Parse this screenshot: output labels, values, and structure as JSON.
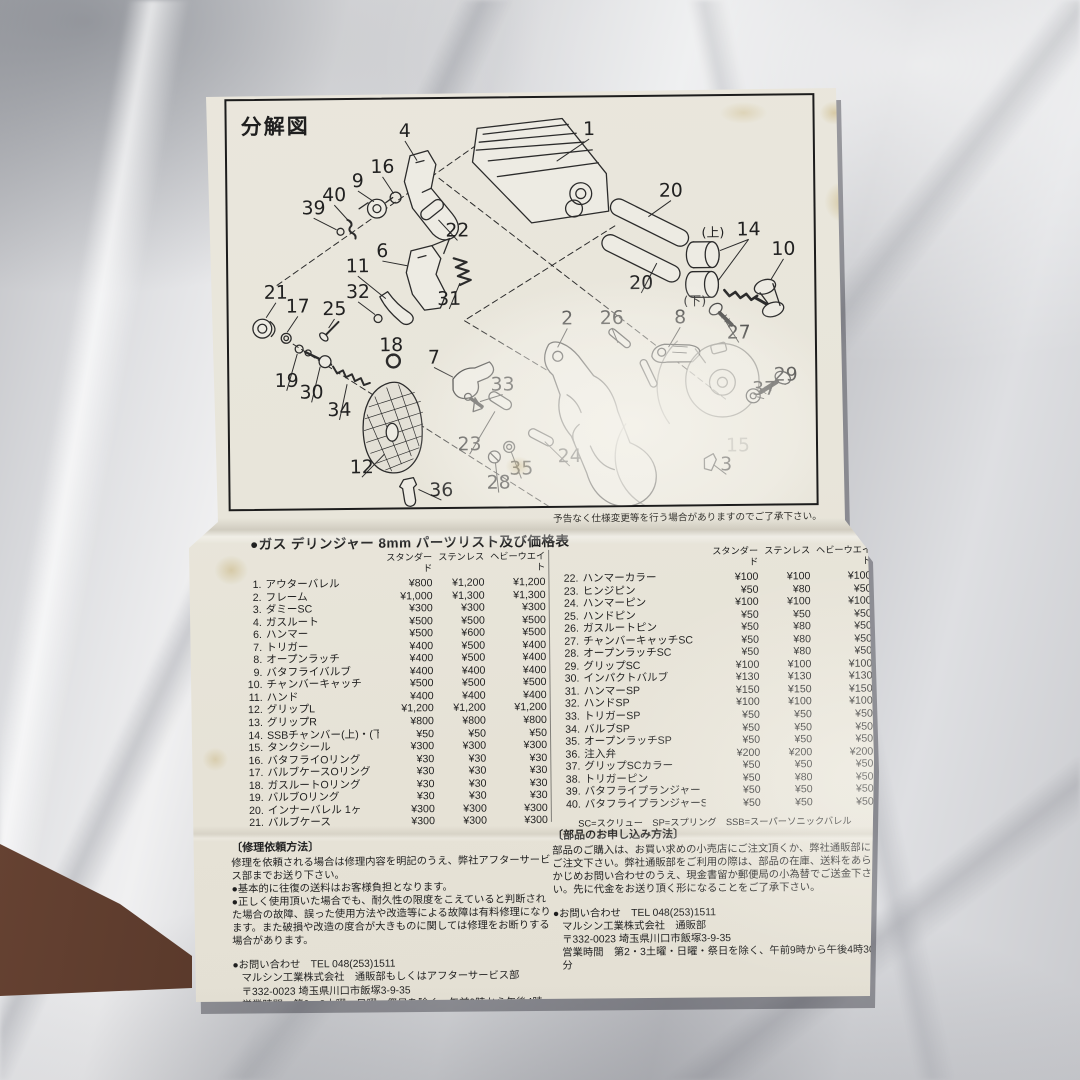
{
  "diagram": {
    "title": "分解図",
    "note": "予告なく仕様変更等を行う場合がありますのでご了承下さい。",
    "labels": [
      {
        "t": "1",
        "x": 365,
        "y": 38,
        "lx": 332,
        "ly": 64
      },
      {
        "t": "4",
        "x": 179,
        "y": 38,
        "lx": 191,
        "ly": 62
      },
      {
        "t": "16",
        "x": 156,
        "y": 74,
        "lx": 167,
        "ly": 95
      },
      {
        "t": "9",
        "x": 131,
        "y": 88,
        "lx": 147,
        "ly": 103
      },
      {
        "t": "40",
        "x": 107,
        "y": 102,
        "lx": 123,
        "ly": 124
      },
      {
        "t": "39",
        "x": 86,
        "y": 115,
        "lx": 109,
        "ly": 131
      },
      {
        "t": "22",
        "x": 231,
        "y": 139,
        "lx": 212,
        "ly": 122
      },
      {
        "t": "20",
        "x": 447,
        "y": 101,
        "lx": 424,
        "ly": 121
      },
      {
        "t": "(上)",
        "x": 489,
        "y": 142,
        "small": 1
      },
      {
        "t": "14",
        "x": 525,
        "y": 141,
        "lx": 496,
        "ly": 156,
        "lx2": 494,
        "ly2": 186
      },
      {
        "t": "10",
        "x": 560,
        "y": 161,
        "lx": 547,
        "ly": 186
      },
      {
        "t": "6",
        "x": 155,
        "y": 159,
        "lx": 180,
        "ly": 168
      },
      {
        "t": "11",
        "x": 130,
        "y": 174,
        "lx": 158,
        "ly": 201
      },
      {
        "t": "31",
        "x": 222,
        "y": 208,
        "lx": 233,
        "ly": 186
      },
      {
        "t": "20",
        "x": 416,
        "y": 194,
        "lx": 432,
        "ly": 168
      },
      {
        "t": "(下)",
        "x": 470,
        "y": 211,
        "small": 1
      },
      {
        "t": "27",
        "x": 514,
        "y": 245,
        "lx": 500,
        "ly": 226
      },
      {
        "t": "2",
        "x": 341,
        "y": 229,
        "lx": 331,
        "ly": 252
      },
      {
        "t": "26",
        "x": 386,
        "y": 229,
        "lx": 392,
        "ly": 248
      },
      {
        "t": "8",
        "x": 455,
        "y": 229,
        "lx": 443,
        "ly": 253
      },
      {
        "t": "21",
        "x": 47,
        "y": 200,
        "lx": 37,
        "ly": 219
      },
      {
        "t": "17",
        "x": 69,
        "y": 214,
        "lx": 58,
        "ly": 234
      },
      {
        "t": "25",
        "x": 106,
        "y": 217,
        "lx": 100,
        "ly": 230
      },
      {
        "t": "32",
        "x": 130,
        "y": 200,
        "lx": 147,
        "ly": 217
      },
      {
        "t": "18",
        "x": 163,
        "y": 254,
        "lx": 165,
        "ly": 259
      },
      {
        "t": "7",
        "x": 206,
        "y": 267,
        "lx": 225,
        "ly": 281
      },
      {
        "t": "33",
        "x": 275,
        "y": 295,
        "lx": 252,
        "ly": 306
      },
      {
        "t": "19",
        "x": 57,
        "y": 289,
        "lx": 68,
        "ly": 256
      },
      {
        "t": "30",
        "x": 82,
        "y": 301,
        "lx": 91,
        "ly": 269
      },
      {
        "t": "34",
        "x": 110,
        "y": 319,
        "lx": 118,
        "ly": 287
      },
      {
        "t": "29",
        "x": 561,
        "y": 288,
        "lx": 551,
        "ly": 289
      },
      {
        "t": "37",
        "x": 539,
        "y": 302,
        "lx": 532,
        "ly": 304
      },
      {
        "t": "23",
        "x": 241,
        "y": 355,
        "lx": 267,
        "ly": 316
      },
      {
        "t": "12",
        "x": 132,
        "y": 377,
        "lx": 155,
        "ly": 358
      },
      {
        "t": "35",
        "x": 293,
        "y": 380,
        "lx": 283,
        "ly": 357
      },
      {
        "t": "28",
        "x": 270,
        "y": 394,
        "lx": 267,
        "ly": 368
      },
      {
        "t": "24",
        "x": 342,
        "y": 368,
        "lx": 317,
        "ly": 347
      },
      {
        "t": "36",
        "x": 212,
        "y": 401,
        "lx": 189,
        "ly": 394
      },
      {
        "t": "3",
        "x": 500,
        "y": 378,
        "lx": 487,
        "ly": 372
      },
      {
        "t": "15",
        "x": 512,
        "y": 359,
        "faint": 1
      }
    ]
  },
  "price_table": {
    "title": "●ガス デリンジャー 8mm パーツリスト及び価格表",
    "columns": [
      "スタンダード",
      "ステンレス",
      "ヘビーウエイト"
    ],
    "left_rows": [
      [
        "1.",
        "アウターバレル",
        "¥800",
        "¥1,200",
        "¥1,200"
      ],
      [
        "2.",
        "フレーム",
        "¥1,000",
        "¥1,300",
        "¥1,300"
      ],
      [
        "3.",
        "ダミーSC",
        "¥300",
        "¥300",
        "¥300"
      ],
      [
        "4.",
        "ガスルート",
        "¥500",
        "¥500",
        "¥500"
      ],
      [
        "6.",
        "ハンマー",
        "¥500",
        "¥600",
        "¥500"
      ],
      [
        "7.",
        "トリガー",
        "¥400",
        "¥500",
        "¥400"
      ],
      [
        "8.",
        "オープンラッチ",
        "¥400",
        "¥500",
        "¥400"
      ],
      [
        "9.",
        "バタフライバルブ",
        "¥400",
        "¥400",
        "¥400"
      ],
      [
        "10.",
        "チャンバーキャッチ",
        "¥500",
        "¥500",
        "¥500"
      ],
      [
        "11.",
        "ハンド",
        "¥400",
        "¥400",
        "¥400"
      ],
      [
        "12.",
        "グリップL",
        "¥1,200",
        "¥1,200",
        "¥1,200"
      ],
      [
        "13.",
        "グリップR",
        "¥800",
        "¥800",
        "¥800"
      ],
      [
        "14.",
        "SSBチャンバー(上)・(下)各",
        "¥50",
        "¥50",
        "¥50"
      ],
      [
        "15.",
        "タンクシール",
        "¥300",
        "¥300",
        "¥300"
      ],
      [
        "16.",
        "バタフライOリング",
        "¥30",
        "¥30",
        "¥30"
      ],
      [
        "17.",
        "バルブケースOリング",
        "¥30",
        "¥30",
        "¥30"
      ],
      [
        "18.",
        "ガスルートOリング",
        "¥30",
        "¥30",
        "¥30"
      ],
      [
        "19.",
        "バルブOリング",
        "¥30",
        "¥30",
        "¥30"
      ],
      [
        "20.",
        "インナーバレル 1ヶ",
        "¥300",
        "¥300",
        "¥300"
      ],
      [
        "21.",
        "バルブケース",
        "¥300",
        "¥300",
        "¥300"
      ]
    ],
    "right_rows": [
      [
        "22.",
        "ハンマーカラー",
        "¥100",
        "¥100",
        "¥100"
      ],
      [
        "23.",
        "ヒンジピン",
        "¥50",
        "¥80",
        "¥50"
      ],
      [
        "24.",
        "ハンマーピン",
        "¥100",
        "¥100",
        "¥100"
      ],
      [
        "25.",
        "ハンドピン",
        "¥50",
        "¥50",
        "¥50"
      ],
      [
        "26.",
        "ガスルートピン",
        "¥50",
        "¥80",
        "¥50"
      ],
      [
        "27.",
        "チャンバーキャッチSC",
        "¥50",
        "¥80",
        "¥50"
      ],
      [
        "28.",
        "オープンラッチSC",
        "¥50",
        "¥80",
        "¥50"
      ],
      [
        "29.",
        "グリップSC",
        "¥100",
        "¥100",
        "¥100"
      ],
      [
        "30.",
        "インパクトバルブ",
        "¥130",
        "¥130",
        "¥130"
      ],
      [
        "31.",
        "ハンマーSP",
        "¥150",
        "¥150",
        "¥150"
      ],
      [
        "32.",
        "ハンドSP",
        "¥100",
        "¥100",
        "¥100"
      ],
      [
        "33.",
        "トリガーSP",
        "¥50",
        "¥50",
        "¥50"
      ],
      [
        "34.",
        "バルブSP",
        "¥50",
        "¥50",
        "¥50"
      ],
      [
        "35.",
        "オープンラッチSP",
        "¥50",
        "¥50",
        "¥50"
      ],
      [
        "36.",
        "注入弁",
        "¥200",
        "¥200",
        "¥200"
      ],
      [
        "37.",
        "グリップSCカラー",
        "¥50",
        "¥50",
        "¥50"
      ],
      [
        "38.",
        "トリガーピン",
        "¥50",
        "¥80",
        "¥50"
      ],
      [
        "39.",
        "バタフライプランジャー",
        "¥50",
        "¥50",
        "¥50"
      ],
      [
        "40.",
        "バタフライプランジャーSP",
        "¥50",
        "¥50",
        "¥50"
      ]
    ],
    "legend": "SC=スクリュー　SP=スプリング　SSB=スーパーソニックバレル"
  },
  "repair": {
    "title": "〔修理依頼方法〕",
    "lines": [
      "修理を依頼される場合は修理内容を明記のうえ、弊社アフターサービス部までお送り下さい。",
      "●基本的に往復の送料はお客様負担となります。",
      "●正しく使用頂いた場合でも、耐久性の限度をこえていると判断された場合の故障、誤った使用方法や改造等による故障は有料修理になります。また破損や改造の度合が大きものに関しては修理をお断りする場合があります。"
    ],
    "contact": [
      "●お問い合わせ　TEL 048(253)1511",
      "マルシン工業株式会社　通販部もしくはアフターサービス部",
      "〒332-0023 埼玉県川口市飯塚3-9-35",
      "営業時間　第2・3土曜・日曜・祭日を除く、午前9時から午後4時30分"
    ]
  },
  "order": {
    "title": "〔部品のお申し込み方法〕",
    "lines": [
      "部品のご購入は、お買い求めの小売店にご注文頂くか、弊社通販部にご注文下さい。弊社通販部をご利用の際は、部品の在庫、送料をあらかじめお問い合わせのうえ、現金書留か郵便局の小為替でご送金下さい。先に代金をお送り頂く形になることをご了承下さい。"
    ],
    "contact": [
      "●お問い合わせ　TEL 048(253)1511",
      "マルシン工業株式会社　通販部",
      "〒332-0023 埼玉県川口市飯塚3-9-35",
      "営業時間　第2・3土曜・日曜・祭日を除く、午前9時から午後4時30分"
    ]
  }
}
